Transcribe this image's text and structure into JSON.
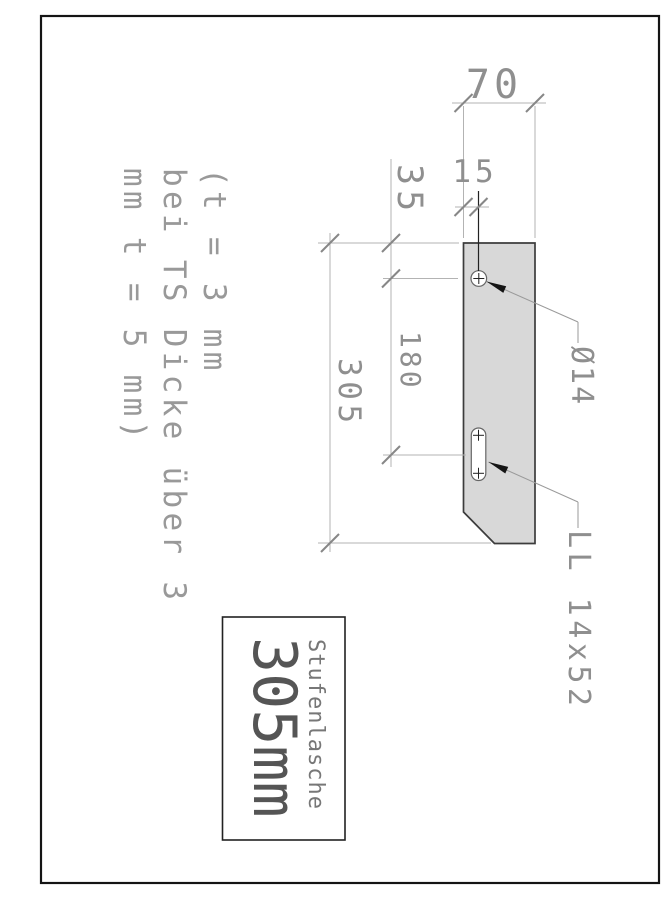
{
  "sheet": {
    "title_block": {
      "name": "Stufenlasche",
      "size": "305mm"
    },
    "note": {
      "line1": "(t = 3 mm",
      "line2": "bei TS Dicke über 3",
      "line3": "mm t = 5 mm)"
    },
    "dimensions": {
      "plate_width": "70",
      "edge_to_hole": "15",
      "top_to_hole_center": "35",
      "hole_to_slot": "180",
      "total_length": "305"
    },
    "labels": {
      "hole": "Ø14",
      "slot": "LL 14x52"
    },
    "colors": {
      "plate_fill": "#d8d8d8",
      "plate_outline": "#3c3c3c",
      "frame": "#141414",
      "dimension_line": "#b3b3b3",
      "tick": "#878787",
      "dim_text": "#8f8f8f",
      "note_text": "#999999",
      "leader": "#9a9a9a",
      "arrowhead": "#151515",
      "title_text": "#555555"
    }
  }
}
